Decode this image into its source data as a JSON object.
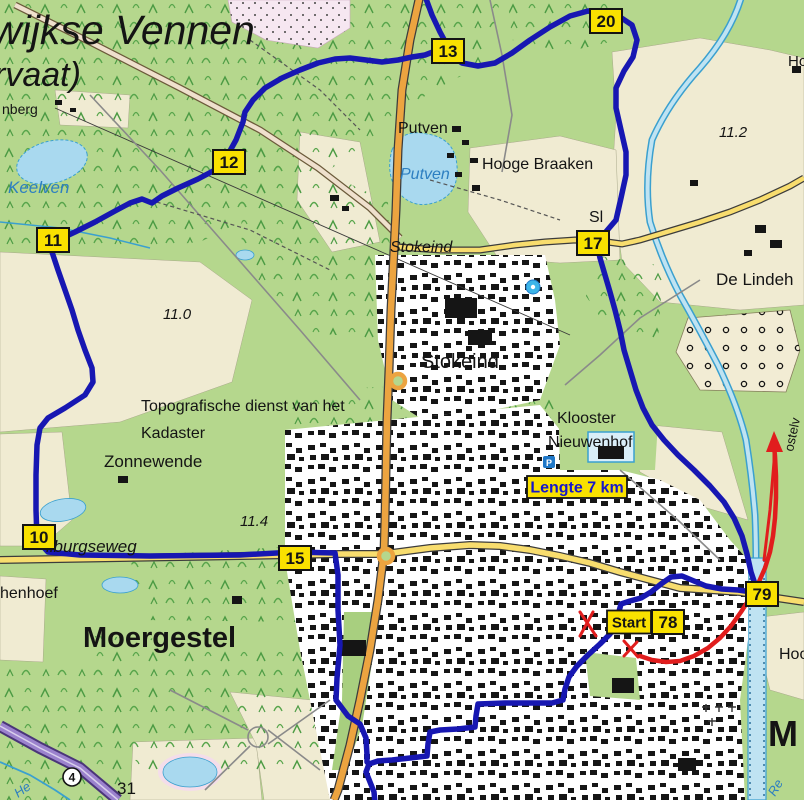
{
  "map_labels": [
    {
      "id": "oisterwijkse-vennen",
      "text": "wijkse Vennen",
      "x": -8,
      "y": 44,
      "size": 41,
      "italic": true,
      "color": "#141414"
    },
    {
      "id": "vervaat",
      "text": "rvaat)",
      "x": -6,
      "y": 86,
      "size": 34,
      "italic": true,
      "color": "#141414"
    },
    {
      "id": "nberg",
      "text": "nberg",
      "x": 2,
      "y": 114,
      "size": 14,
      "color": "#141414"
    },
    {
      "id": "keelven-lake-name",
      "text": "Keelven",
      "x": 8,
      "y": 193,
      "size": 17,
      "italic": true,
      "color": "#2d7fc1"
    },
    {
      "id": "putven-hamlet",
      "text": "Putven",
      "x": 398,
      "y": 133,
      "size": 16,
      "color": "#141414"
    },
    {
      "id": "putven-lake-name",
      "text": "Putven",
      "x": 400,
      "y": 179,
      "size": 16,
      "italic": true,
      "color": "#2d7fc1"
    },
    {
      "id": "hooge-braaken",
      "text": "Hooge Braaken",
      "x": 482,
      "y": 169,
      "size": 16,
      "color": "#141414"
    },
    {
      "id": "stokeind-road-name",
      "text": "Stokeind",
      "x": 390,
      "y": 252,
      "size": 16,
      "italic": true,
      "color": "#141414"
    },
    {
      "id": "stokeind-village",
      "text": "Stokeind",
      "x": 421,
      "y": 368,
      "size": 20,
      "color": "#141414"
    },
    {
      "id": "sl-fragment",
      "text": "Sl",
      "x": 589,
      "y": 222,
      "size": 16,
      "color": "#141414"
    },
    {
      "id": "de-lindeh",
      "text": "De Lindeh",
      "x": 716,
      "y": 285,
      "size": 17,
      "color": "#141414"
    },
    {
      "id": "ho-topright",
      "text": "Ho",
      "x": 788,
      "y": 66,
      "size": 15,
      "color": "#141414"
    },
    {
      "id": "height-11-2",
      "text": "11.2",
      "x": 719,
      "y": 137,
      "size": 15,
      "italic": true,
      "color": "#141414"
    },
    {
      "id": "height-11-0",
      "text": "11.0",
      "x": 163,
      "y": 319,
      "size": 15,
      "italic": true,
      "color": "#141414"
    },
    {
      "id": "height-11-4",
      "text": "11.4",
      "x": 240,
      "y": 526,
      "size": 15,
      "italic": true,
      "color": "#141414"
    },
    {
      "id": "kadaster-credit-1",
      "text": "Topografische dienst van het",
      "x": 141,
      "y": 411,
      "size": 16,
      "color": "#141414"
    },
    {
      "id": "kadaster-credit-2",
      "text": "Kadaster",
      "x": 141,
      "y": 438,
      "size": 16,
      "color": "#141414"
    },
    {
      "id": "zonnewende",
      "text": "Zonnewende",
      "x": 104,
      "y": 467,
      "size": 17,
      "color": "#141414"
    },
    {
      "id": "tilburgseweg",
      "text": "ilburgseweg",
      "x": 46,
      "y": 552,
      "size": 17,
      "italic": true,
      "color": "#141414"
    },
    {
      "id": "henhoef",
      "text": "henhoef",
      "x": 0,
      "y": 598,
      "size": 16,
      "color": "#141414"
    },
    {
      "id": "moergestel",
      "text": "Moergestel",
      "x": 83,
      "y": 647,
      "size": 29,
      "weight": "bold",
      "color": "#141414"
    },
    {
      "id": "klooster-1",
      "text": "Klooster",
      "x": 557,
      "y": 423,
      "size": 16,
      "color": "#141414"
    },
    {
      "id": "klooster-2",
      "text": "Nieuwenhof",
      "x": 548,
      "y": 447,
      "size": 16,
      "color": "#141414"
    },
    {
      "id": "hoo-fragment",
      "text": "Hoo",
      "x": 779,
      "y": 659,
      "size": 16,
      "color": "#141414"
    },
    {
      "id": "m-large-fragment",
      "text": "M",
      "x": 768,
      "y": 746,
      "size": 36,
      "weight": "bold",
      "color": "#141414"
    },
    {
      "id": "re-river-fragment",
      "text": "Re",
      "x": 775,
      "y": 797,
      "size": 13,
      "italic": true,
      "color": "#2d7fc1",
      "rotate": -60
    },
    {
      "id": "ostelv-street-fragment",
      "text": "ostelv",
      "x": 793,
      "y": 452,
      "size": 13,
      "color": "#141414",
      "rotate": -78
    },
    {
      "id": "road-31",
      "text": "31",
      "x": 117,
      "y": 794,
      "size": 17,
      "color": "#141414"
    },
    {
      "id": "he-stream-fragment",
      "text": "He",
      "x": 18,
      "y": 798,
      "size": 13,
      "italic": true,
      "color": "#2d7fc1",
      "rotate": -35
    }
  ],
  "waypoints": [
    {
      "label": "10",
      "x": 39,
      "y": 537
    },
    {
      "label": "11",
      "x": 53,
      "y": 240
    },
    {
      "label": "12",
      "x": 229,
      "y": 162
    },
    {
      "label": "13",
      "x": 448,
      "y": 51
    },
    {
      "label": "15",
      "x": 295,
      "y": 558
    },
    {
      "label": "17",
      "x": 593,
      "y": 243
    },
    {
      "label": "20",
      "x": 606,
      "y": 21
    },
    {
      "label": "78",
      "x": 668,
      "y": 622
    },
    {
      "label": "79",
      "x": 762,
      "y": 594
    }
  ],
  "badges": {
    "start": {
      "text": "Start",
      "x": 629,
      "y": 622,
      "w": 44,
      "h": 23,
      "text_color": "#141414"
    },
    "length": {
      "text": "Lengte 7 km",
      "x": 577,
      "y": 487,
      "w": 100,
      "h": 22,
      "text_color": "#1616cc"
    }
  },
  "road_number_badge": {
    "text": "4",
    "x": 72,
    "y": 777
  },
  "routes": {
    "blue_east": {
      "points": "425,-4 432,15 440,32 447,45 452,56 462,63 478,66 495,63 512,53 530,40 550,27 570,16 588,11 605,14 620,17 632,25 637,40 633,57 624,71 616,88 616,108 621,130 626,152 626,175 621,198 616,220 604,234 597,244 600,258 605,275 610,292 615,310 620,330 624,350 630,370 636,390 643,408 652,425 664,440 678,455 694,470 710,486 724,502 734,518 742,536 747,554 751,572 757,590 752,592 738,590 722,589 706,586 694,581 682,576 671,577 661,584 651,592 641,598 630,601 621,604 618,615 616,625 610,634 600,644 588,655 577,666 569,677 565,689 563,700 552,703 530,703 505,703 478,704 476,716 475,727 458,729 440,730 430,732 428,744 427,756 410,758 392,760 378,761 369,764 366,772 370,782 374,792 375,803"
    },
    "blue_west": {
      "points": "447,45 438,50 425,55 412,57 398,60 382,62 366,60 350,58 335,59 318,63 300,70 282,78 265,88 253,100 245,112 243,122 236,140 226,158 215,170 198,179 178,188 162,196 152,203 142,199 130,203 115,211 95,222 75,232 58,240 52,252 58,270 65,290 72,310 78,330 85,350 92,368 93,382 85,395 65,408 48,418 40,428 37,445 36,475 36,510 37,540 48,552 80,555 150,556 240,555 295,552 335,553 338,575 338,610 340,645 337,678 336,700 348,716 360,724 366,738 367,755 367,762"
    },
    "red_arrow": {
      "points": "640,656 652,660 666,662 680,661 694,656 708,648 720,638 731,626 741,612 750,598 758,584 765,568 770,552 773,536 775,518 776,498 776,476 775,456 774,446"
    },
    "red_retrace": {
      "points": "764,560 770,510 774,462 774,448"
    },
    "red_arrowhead": "766,452 774,431 783,452",
    "red_marks": [
      {
        "x1": 580,
        "y1": 612,
        "x2": 596,
        "y2": 636
      },
      {
        "x1": 593,
        "y1": 612,
        "x2": 580,
        "y2": 636
      },
      {
        "x1": 624,
        "y1": 641,
        "x2": 638,
        "y2": 657
      },
      {
        "x1": 637,
        "y1": 642,
        "x2": 624,
        "y2": 656
      }
    ]
  },
  "icons": [
    {
      "name": "parking-icon",
      "glyph": "P",
      "x": 549,
      "y": 462
    },
    {
      "name": "poi-icon",
      "glyph": "",
      "x": 533,
      "y": 287
    }
  ],
  "colors": {
    "map_green": "#b5d78d",
    "field_cream": "#f0ebd2",
    "forest_tree": "#4c9b44",
    "heath_pink": "#f6e7f1",
    "water_fill": "#a9d9ef",
    "water_line": "#3aa0cf",
    "road_yellow": "#f8dd6e",
    "road_orange": "#eca440",
    "motorway_purple": "#7a5cb8",
    "urban_bg": "#ffffff",
    "building": "#151515",
    "route_blue": "#1717b2",
    "route_red": "#e11d1d",
    "marker_yellow": "#f9e100"
  }
}
